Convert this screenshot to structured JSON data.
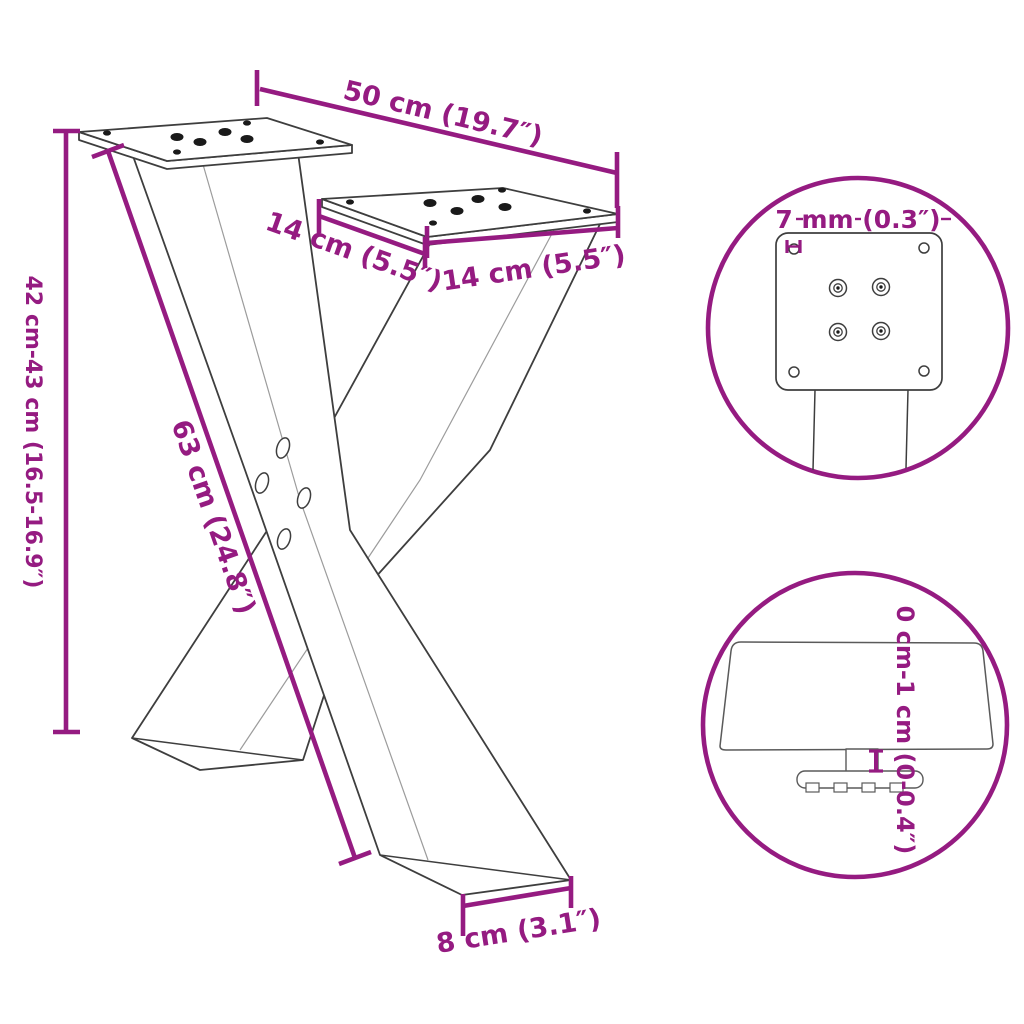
{
  "colors": {
    "accent": "#951B81",
    "outline": "#3E3E3E",
    "crease": "#9C9C9C",
    "hardware": "#1A1A1A",
    "background": "#FFFFFF"
  },
  "labels": {
    "overall_width": "50 cm (19.7″)",
    "plate_depth": "14 cm (5.5″)",
    "plate_width": "14 cm (5.5″)",
    "height_range": "42 cm-43 cm (16.5-16.9″)",
    "diagonal_length": "63 cm (24.8″)",
    "foot_width": "8 cm (3.1″)",
    "plate_thickness": "7 mm (0.3″)",
    "foot_height_adjustment": "0 cm-1 cm (0-0.4″)"
  }
}
